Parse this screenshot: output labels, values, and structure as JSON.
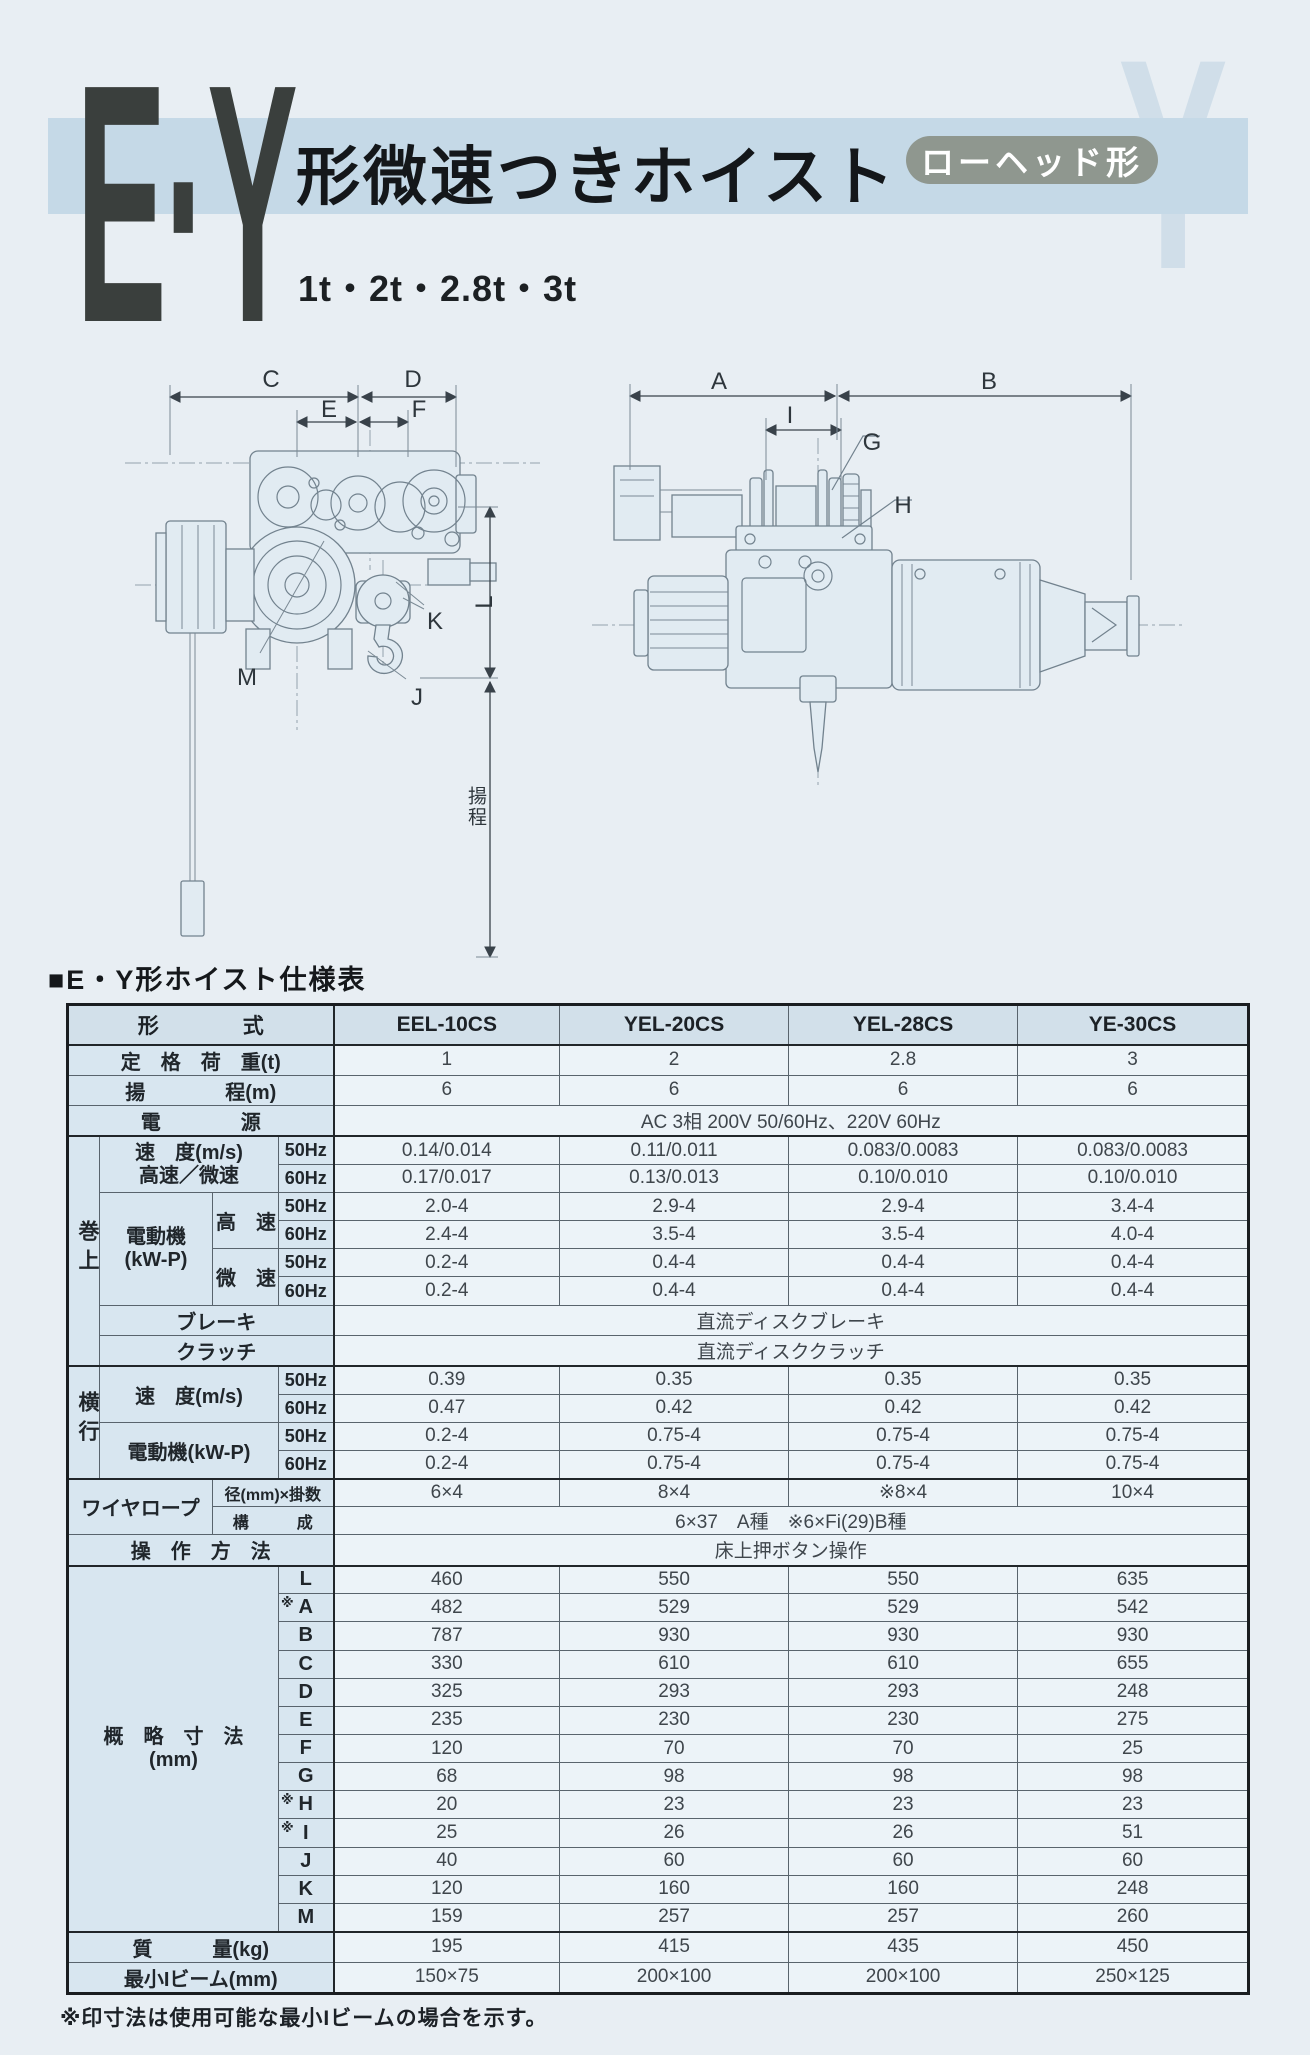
{
  "header": {
    "logo": "E·Y",
    "title": "形微速つきホイスト",
    "badge": "ローヘッド形",
    "capacities": "1t・2t・2.8t・3t",
    "ghost": "Y"
  },
  "diagram_labels": {
    "c": "C",
    "d": "D",
    "e": "E",
    "f": "F",
    "l": "L",
    "k": "K",
    "m": "M",
    "j": "J",
    "a": "A",
    "b": "B",
    "i": "I",
    "g": "G",
    "h": "H",
    "lift": "揚程"
  },
  "table": {
    "title": "■E・Y形ホイスト仕様表",
    "header_label": "形　　　　式",
    "models": [
      "EEL-10CS",
      "YEL-20CS",
      "YEL-28CS",
      "YE-30CS"
    ],
    "hz50": "50Hz",
    "hz60": "60Hz",
    "capacity": {
      "label": "定　格　荷　重(t)",
      "values": [
        "1",
        "2",
        "2.8",
        "3"
      ]
    },
    "lift": {
      "label": "揚　　　　程(m)",
      "values": [
        "6",
        "6",
        "6",
        "6"
      ]
    },
    "power": {
      "label": "電　　　　源",
      "value": "AC 3相 200V 50/60Hz、220V 60Hz"
    },
    "hoist_group": "巻上",
    "speed_label1": "速　度(m/s)",
    "speed_label2": "高速／微速",
    "hoist_speed_50": [
      "0.14/0.014",
      "0.11/0.011",
      "0.083/0.0083",
      "0.083/0.0083"
    ],
    "hoist_speed_60": [
      "0.17/0.017",
      "0.13/0.013",
      "0.10/0.010",
      "0.10/0.010"
    ],
    "motor_label1": "電動機",
    "motor_label2": "(kW-P)",
    "fast_label": "高　速",
    "slow_label": "微　速",
    "hoist_motor_fast_50": [
      "2.0-4",
      "2.9-4",
      "2.9-4",
      "3.4-4"
    ],
    "hoist_motor_fast_60": [
      "2.4-4",
      "3.5-4",
      "3.5-4",
      "4.0-4"
    ],
    "hoist_motor_slow_50": [
      "0.2-4",
      "0.4-4",
      "0.4-4",
      "0.4-4"
    ],
    "hoist_motor_slow_60": [
      "0.2-4",
      "0.4-4",
      "0.4-4",
      "0.4-4"
    ],
    "brake": {
      "label": "ブレーキ",
      "value": "直流ディスクブレーキ"
    },
    "clutch": {
      "label": "クラッチ",
      "value": "直流ディスククラッチ"
    },
    "traverse_group": "横行",
    "t_speed_label": "速　度(m/s)",
    "t_speed_50": [
      "0.39",
      "0.35",
      "0.35",
      "0.35"
    ],
    "t_speed_60": [
      "0.47",
      "0.42",
      "0.42",
      "0.42"
    ],
    "t_motor_label": "電動機(kW-P)",
    "t_motor_50": [
      "0.2-4",
      "0.75-4",
      "0.75-4",
      "0.75-4"
    ],
    "t_motor_60": [
      "0.2-4",
      "0.75-4",
      "0.75-4",
      "0.75-4"
    ],
    "rope_label": "ワイヤロープ",
    "rope_dia_label": "径(mm)×掛数",
    "rope_dia": [
      "6×4",
      "8×4",
      "※8×4",
      "10×4"
    ],
    "rope_const_label": "構　　　成",
    "rope_const": "6×37　A種　※6×Fi(29)B種",
    "operation": {
      "label": "操　作　方　法",
      "value": "床上押ボタン操作"
    },
    "dims_label1": "概　略　寸　法",
    "dims_label2": "(mm)",
    "dims": [
      {
        "mark": "",
        "letter": "L",
        "values": [
          "460",
          "550",
          "550",
          "635"
        ]
      },
      {
        "mark": "※",
        "letter": "A",
        "values": [
          "482",
          "529",
          "529",
          "542"
        ]
      },
      {
        "mark": "",
        "letter": "B",
        "values": [
          "787",
          "930",
          "930",
          "930"
        ]
      },
      {
        "mark": "",
        "letter": "C",
        "values": [
          "330",
          "610",
          "610",
          "655"
        ]
      },
      {
        "mark": "",
        "letter": "D",
        "values": [
          "325",
          "293",
          "293",
          "248"
        ]
      },
      {
        "mark": "",
        "letter": "E",
        "values": [
          "235",
          "230",
          "230",
          "275"
        ]
      },
      {
        "mark": "",
        "letter": "F",
        "values": [
          "120",
          "70",
          "70",
          "25"
        ]
      },
      {
        "mark": "",
        "letter": "G",
        "values": [
          "68",
          "98",
          "98",
          "98"
        ]
      },
      {
        "mark": "※",
        "letter": "H",
        "values": [
          "20",
          "23",
          "23",
          "23"
        ]
      },
      {
        "mark": "※",
        "letter": "I",
        "values": [
          "25",
          "26",
          "26",
          "51"
        ]
      },
      {
        "mark": "",
        "letter": "J",
        "values": [
          "40",
          "60",
          "60",
          "60"
        ]
      },
      {
        "mark": "",
        "letter": "K",
        "values": [
          "120",
          "160",
          "160",
          "248"
        ]
      },
      {
        "mark": "",
        "letter": "M",
        "values": [
          "159",
          "257",
          "257",
          "260"
        ]
      }
    ],
    "mass": {
      "label": "質　　　量(kg)",
      "values": [
        "195",
        "415",
        "435",
        "450"
      ]
    },
    "min_beam": {
      "label": "最小Iビーム(mm)",
      "values": [
        "150×75",
        "200×100",
        "200×100",
        "250×125"
      ]
    }
  },
  "footnote": "※印寸法は使用可能な最小Iビームの場合を示す。"
}
